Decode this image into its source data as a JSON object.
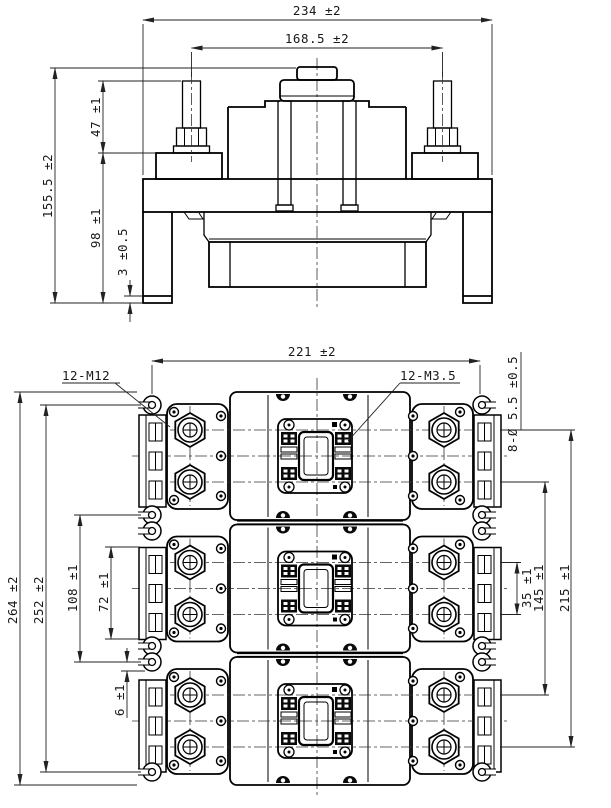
{
  "front_view": {
    "dim_overall_width": "234 ±2",
    "dim_terminal_spacing": "168.5 ±2",
    "dim_terminal_height": "47 ±1",
    "dim_overall_height": "155.5 ±2",
    "dim_body_height": "98 ±1",
    "dim_foot_thickness": "3 ±0.5"
  },
  "plan_view": {
    "dim_body_width": "221 ±2",
    "label_main_terminals": "12-M12",
    "label_aux_terminals": "12-M3.5",
    "label_mounting_holes": "8-Ø 5.5 ±0.5",
    "dim_overall_length": "264 ±2",
    "dim_mounting_span": "252 ±2",
    "dim_fixing_span": "108 ±1",
    "dim_module_length": "72 ±1",
    "dim_edge_offset": "6 ±1",
    "dim_pole_screw_pitch": "35 ±1",
    "dim_screw_span_inner": "145 ±1",
    "dim_screw_span_outer": "215 ±1"
  },
  "colors": {
    "line": "#000000",
    "dimension": "#222222",
    "background": "#ffffff"
  }
}
